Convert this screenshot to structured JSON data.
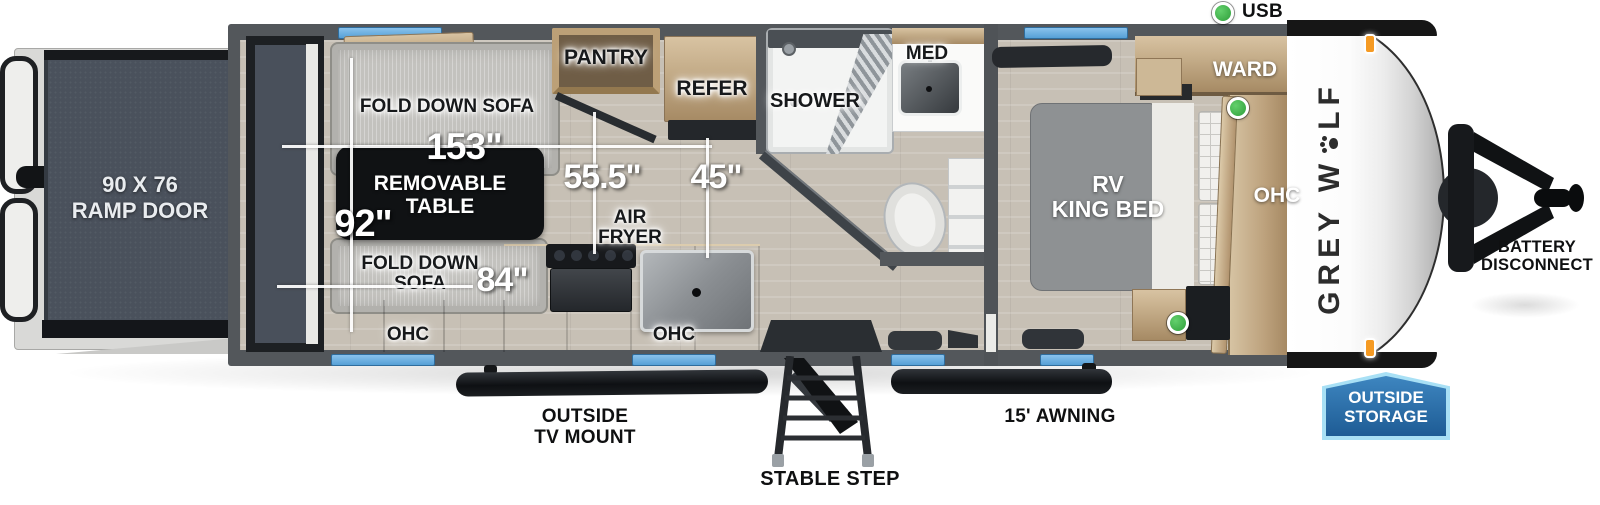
{
  "legend": {
    "usb": "USB"
  },
  "measurements": {
    "garage_length": "153\"",
    "interior_width": "92\"",
    "kitchen_to_wall": "55.5\"",
    "entry_width": "45\"",
    "sofa_length": "84\""
  },
  "interior": {
    "fold_down_sofa_top": "FOLD DOWN SOFA",
    "removable_table_l1": "REMOVABLE",
    "removable_table_l2": "TABLE",
    "fold_down_sofa_bottom_l1": "FOLD DOWN",
    "fold_down_sofa_bottom_l2": "SOFA",
    "ohc_left": "OHC",
    "ohc_kitchen": "OHC",
    "ohc_bedroom": "OHC",
    "pantry": "PANTRY",
    "refer": "REFER",
    "air_fryer_l1": "AIR",
    "air_fryer_l2": "FRYER",
    "shower": "SHOWER",
    "med": "MED",
    "ward": "WARD",
    "rv_king_bed_l1": "RV",
    "rv_king_bed_l2": "KING BED"
  },
  "exterior": {
    "ramp_door_l1": "90 X 76",
    "ramp_door_l2": "RAMP DOOR",
    "outside_tv_mount_l1": "OUTSIDE",
    "outside_tv_mount_l2": "TV MOUNT",
    "stable_step": "STABLE STEP",
    "awning": "15' AWNING",
    "outside_storage_l1": "OUTSIDE",
    "outside_storage_l2": "STORAGE",
    "battery_disconnect_l1": "BATTERY",
    "battery_disconnect_l2": "DISCONNECT",
    "brand_l1": "GREY W",
    "brand_l2": "LF"
  },
  "colors": {
    "window_blue": "#68ace0",
    "usb_green": "#3fb54a",
    "badge_blue": "#2a6ca5",
    "badge_border": "#a8e0f5",
    "marker_orange": "#f59a23"
  }
}
